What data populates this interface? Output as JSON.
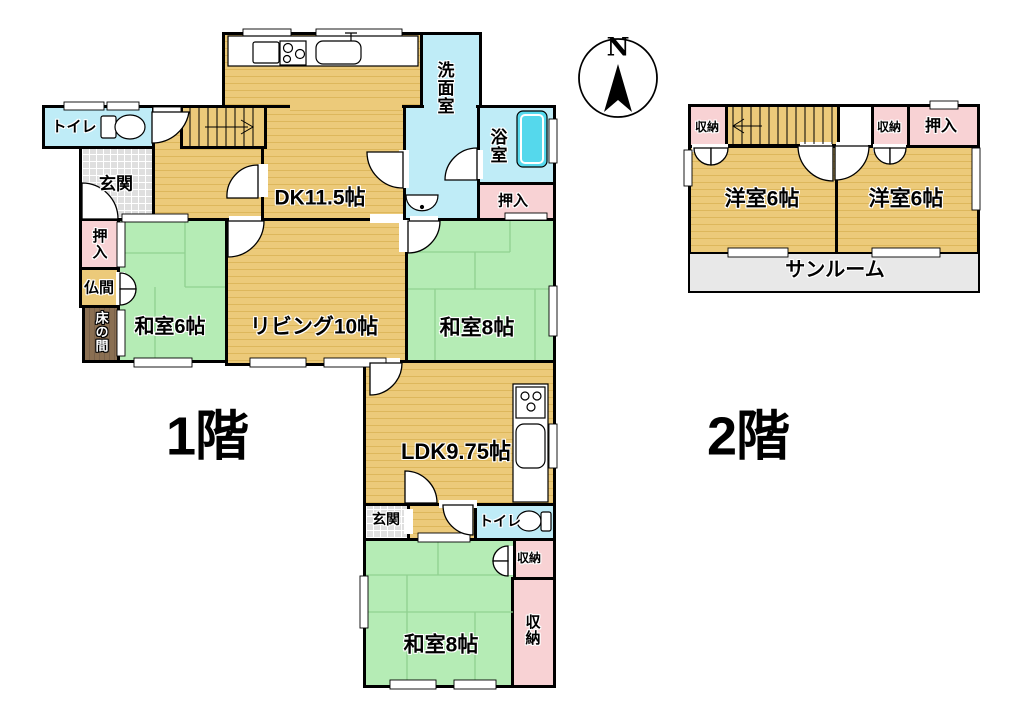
{
  "compass": {
    "north_label": "N"
  },
  "floor1": {
    "title": "1階",
    "rooms": {
      "toilet1": "トイレ",
      "genkan1": "玄関",
      "dk": "DK11.5帖",
      "washroom": "洗面室",
      "bathroom": "浴室",
      "oshiire_bath": "押入",
      "oshiire_left": "押入",
      "butsuma": "仏間",
      "tokonoma": "床の間",
      "washitsu6": "和室6帖",
      "living": "リビング10帖",
      "washitsu8_upper": "和室8帖",
      "ldk": "LDK9.75帖",
      "genkan2": "玄関",
      "toilet2": "トイレ",
      "shuno_small": "収納",
      "washitsu8_lower": "和室8帖",
      "shuno_tall": "収納"
    }
  },
  "floor2": {
    "title": "2階",
    "rooms": {
      "shuno_left": "収納",
      "shuno_mid": "収納",
      "oshiire": "押入",
      "yoshitsu_left": "洋室6帖",
      "yoshitsu_right": "洋室6帖",
      "sunroom": "サンルーム"
    }
  },
  "colors": {
    "wall": "#000000",
    "wood_floor": "#ECCA7A",
    "wood_floor_stripe": "#DDB75C",
    "tatami_green": "#B5ECB5",
    "water_room_cyan": "#BFECF7",
    "bathtub_cyan": "#55D8EC",
    "closet_pink": "#F8D2D4",
    "entrance_gray": "#DFDFDF",
    "tokonoma_brown": "#8A6F52",
    "sunroom_gray": "#E8E8E8"
  },
  "icons": [
    "north-arrow-icon",
    "toilet-icon",
    "stove-icon",
    "kitchen-sink-icon",
    "bathtub-icon",
    "washbasin-icon",
    "stairs-icon",
    "door-arc-icon",
    "window-icon"
  ]
}
